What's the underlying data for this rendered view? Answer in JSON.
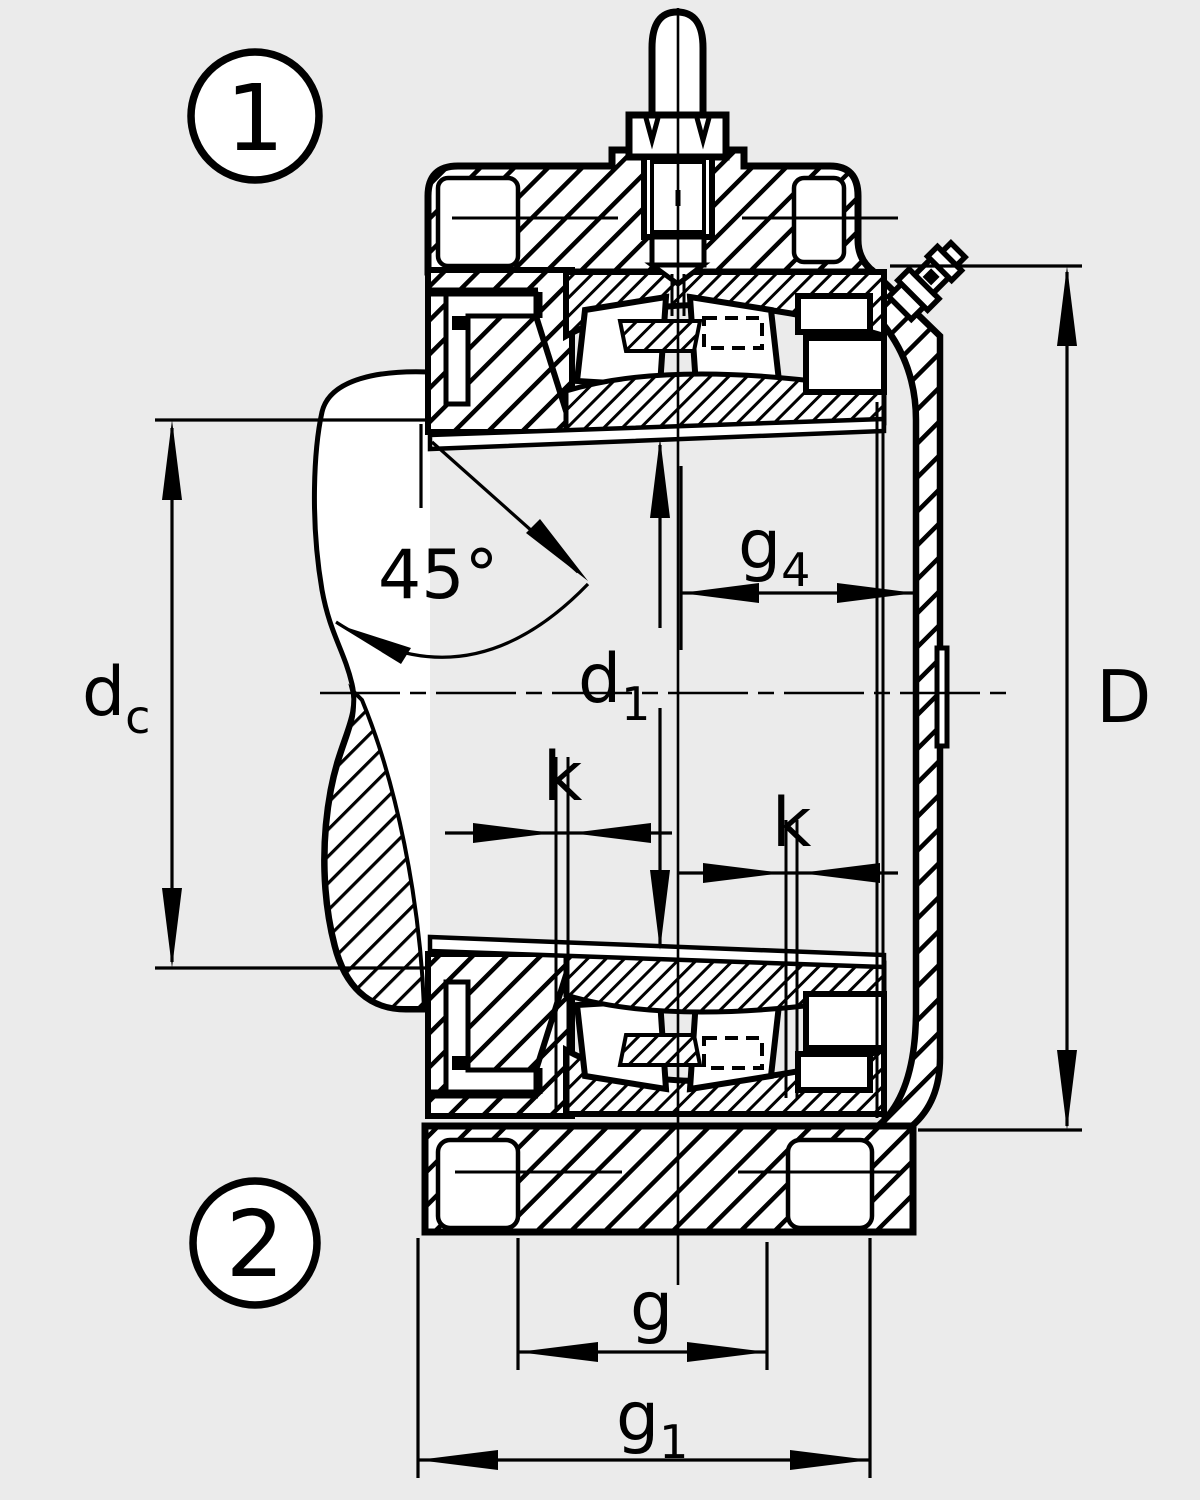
{
  "drawing": {
    "background": "#ebebeb",
    "line_color": "#000000",
    "fill_color": "#ffffff",
    "callouts": {
      "top": "1",
      "bottom": "2"
    },
    "dimensions": {
      "angle": "45°",
      "dc": {
        "base": "d",
        "sub": "c"
      },
      "d1": {
        "base": "d",
        "sub": "1"
      },
      "g4": {
        "base": "g",
        "sub": "4"
      },
      "k_left": "k",
      "k_right": "k",
      "D": "D",
      "g": "g",
      "g1": {
        "base": "g",
        "sub": "1"
      }
    }
  }
}
